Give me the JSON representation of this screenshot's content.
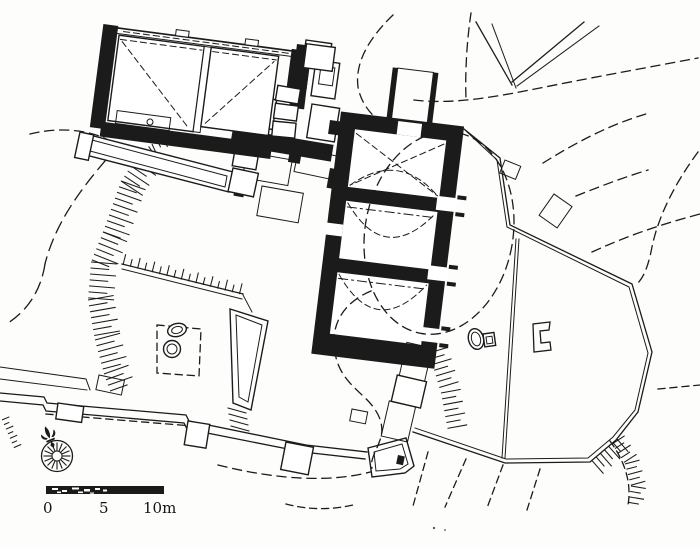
{
  "figure": {
    "kind": "site-plan-drawing",
    "paper_color": "#fdfdfb",
    "ink_color": "#1b1b1b"
  },
  "scale_bar": {
    "label_start": "0",
    "label_mid": "5",
    "label_end": "10m"
  },
  "compass": {
    "icon": "compass-rose-north-arrow"
  }
}
